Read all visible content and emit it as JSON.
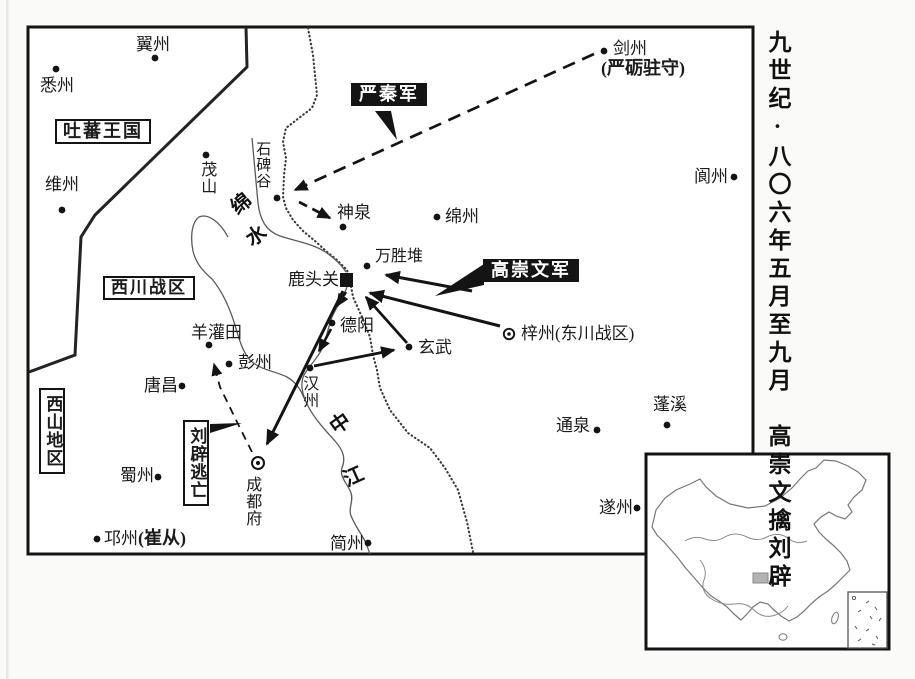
{
  "caption": {
    "vertical_title": "九世纪·八〇六年五月至九月　高崇文擒刘辟"
  },
  "regions": {
    "tubo": {
      "label": "吐蕃王国"
    },
    "xichuan": {
      "label": "西川战区"
    },
    "xishan": {
      "label": "西山地区"
    }
  },
  "armies": {
    "yanqin": {
      "label": "严秦军"
    },
    "gaochongwen": {
      "label": "高崇文军"
    },
    "liupi_escape": {
      "label": "刘辟逃亡"
    }
  },
  "rivers": {
    "mianshui": {
      "char1": "绵",
      "char2": "水"
    },
    "zhongjiang": {
      "char1": "中",
      "char2": "江"
    },
    "shibeigu": {
      "label": "石碑谷"
    }
  },
  "places": {
    "yizhou": {
      "label": "翼州"
    },
    "xizhou": {
      "label": "悉州"
    },
    "weizhou": {
      "label": "维州"
    },
    "maoshan": {
      "label": "茂山"
    },
    "jianzhou": {
      "label": "剑州",
      "note": "(严砺驻守)"
    },
    "shenquan": {
      "label": "神泉"
    },
    "mianzhou": {
      "label": "绵州"
    },
    "langzhou": {
      "label": "阆州"
    },
    "wanshengdui": {
      "label": "万胜堆"
    },
    "lutouguan": {
      "label": "鹿头关"
    },
    "zizhou": {
      "label": "梓州(东川战区)"
    },
    "deyang": {
      "label": "德阳"
    },
    "yangguantian": {
      "label": "羊灌田"
    },
    "pengzhou": {
      "label": "彭州"
    },
    "xuanwu": {
      "label": "玄武"
    },
    "tangchang": {
      "label": "唐昌"
    },
    "hanzhou": {
      "label": "汉州"
    },
    "shuzhou": {
      "label": "蜀州"
    },
    "chengdufu": {
      "label": "成都府"
    },
    "qiongzhou": {
      "label": "邛州",
      "note": "(崔从)"
    },
    "jianzhou_south": {
      "label": "简州"
    },
    "tongquan": {
      "label": "通泉"
    },
    "pengxi": {
      "label": "蓬溪"
    },
    "suizhou": {
      "label": "遂州"
    }
  },
  "colors": {
    "ink": "#1a1a1a",
    "army_box_bg": "#141414",
    "army_box_text": "#ffffff",
    "river": "#5a5a5a",
    "paper": "#fafaf8"
  }
}
